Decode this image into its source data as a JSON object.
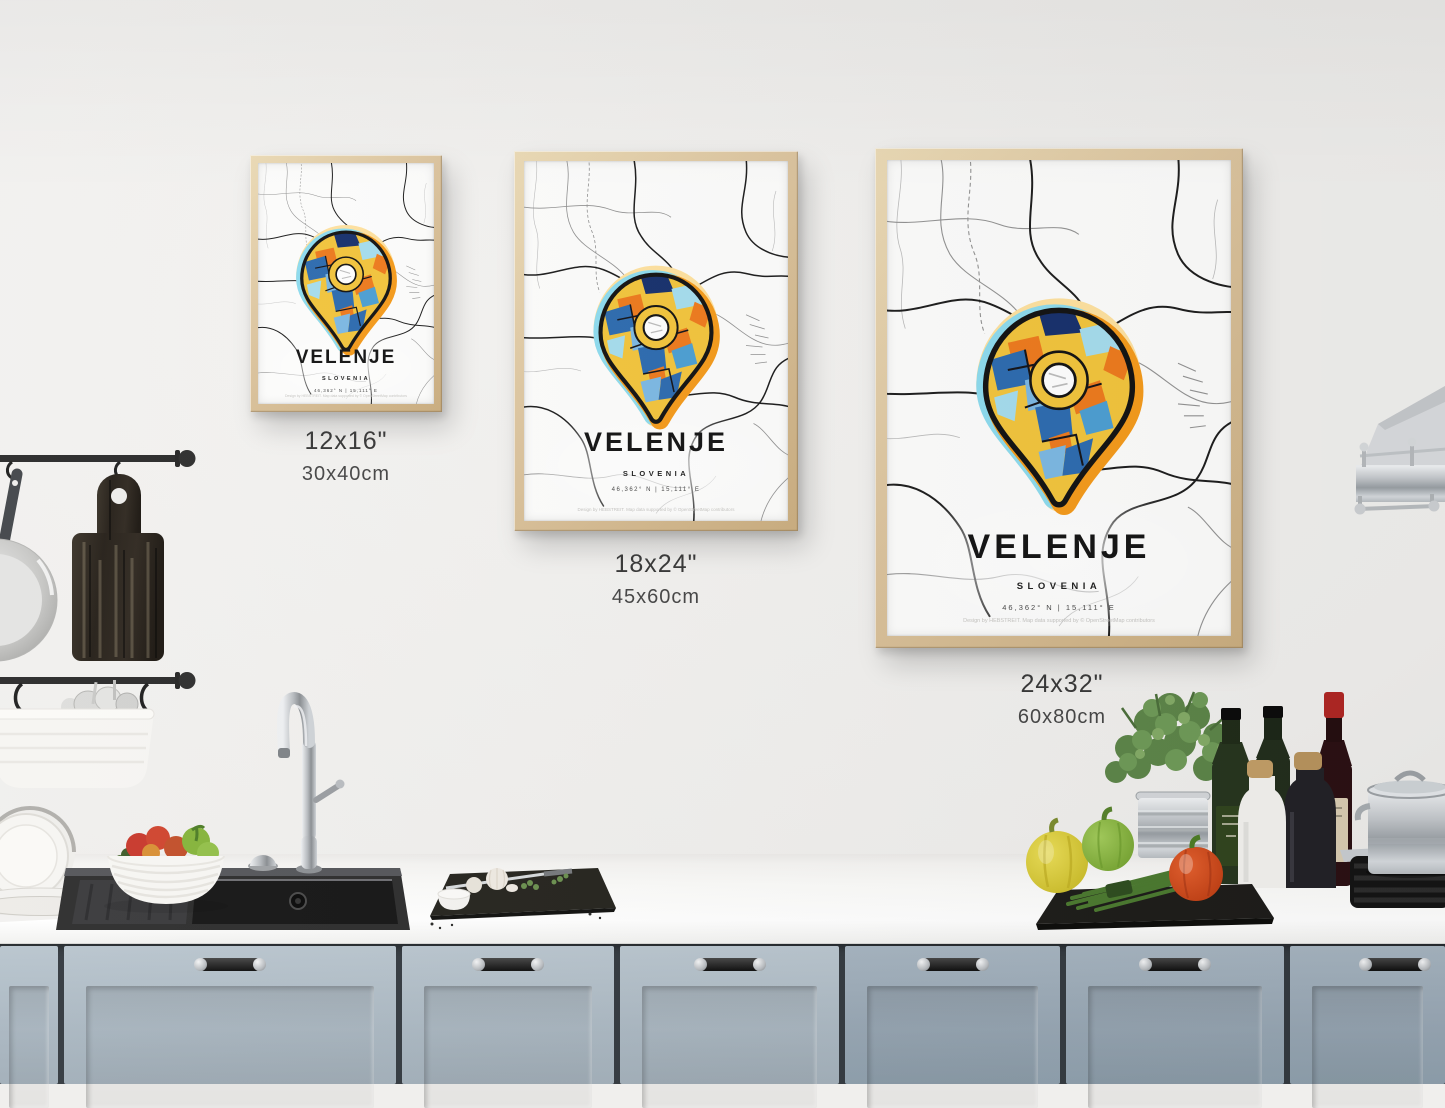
{
  "poster": {
    "title": "VELENJE",
    "subtitle": "SLOVENIA",
    "coordinates": "46,362° N | 15,111° E",
    "fine_print": "Design by HEBSTREIT. Map data supported by © OpenStreetMap contributors"
  },
  "size_options": [
    {
      "inches": "12x16\"",
      "cm": "30x40cm"
    },
    {
      "inches": "18x24\"",
      "cm": "45x60cm"
    },
    {
      "inches": "24x32\"",
      "cm": "60x80cm"
    }
  ],
  "colors": {
    "wall": "#f0efed",
    "frame-wood": "#dcc49e",
    "counter": "#fbfbf9",
    "cabinet-left": "#aab7c1",
    "cabinet-right": "#97a6b3",
    "label-text": "#3a3a3a",
    "pin-yellow": "#f3c53d",
    "pin-orange": "#ee7b1e",
    "pin-blue": "#2e6cb0",
    "pin-light-blue": "#7db9e3",
    "pin-cyan": "#a6ddee",
    "pin-navy": "#18316d",
    "pin-outline": "#141414",
    "halo-yellow": "#ffe2a0",
    "halo-cyan": "#8edcef",
    "halo-orange": "#f59b1c",
    "map-road-dark": "#1e1e1e",
    "map-road-light": "#939393"
  }
}
